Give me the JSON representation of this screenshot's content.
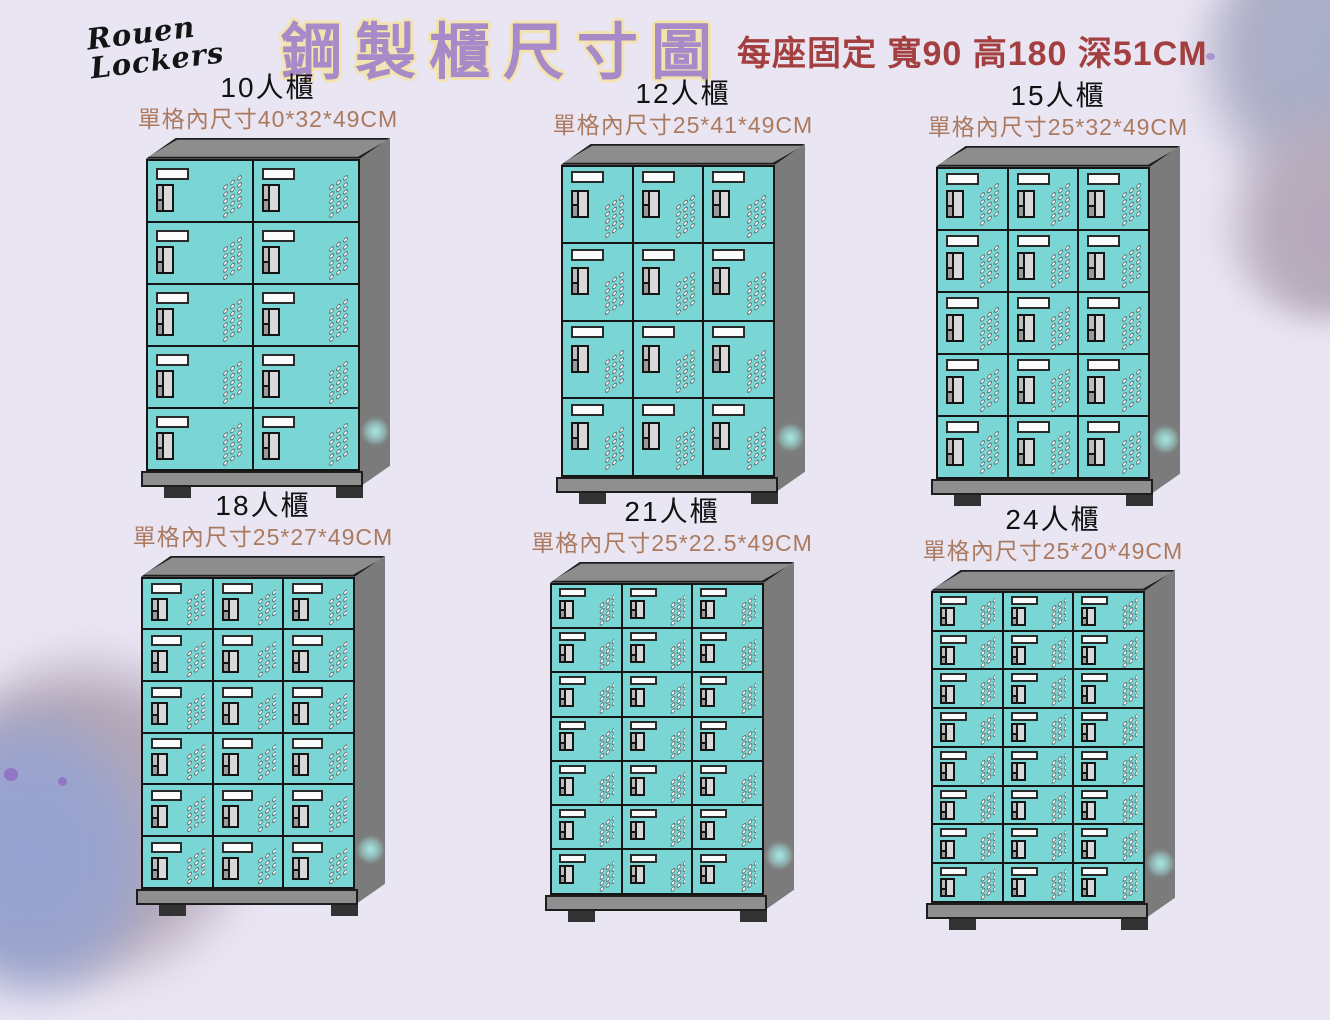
{
  "header": {
    "brand": "Rouen Lockers",
    "title": "鋼製櫃尺寸圖",
    "subtitle": "每座固定 寬90 高180 深51CM"
  },
  "colors": {
    "background": "#eae5f3",
    "title_purple": "#a78bc9",
    "title_outline_cream": "#f3e3ae",
    "subtitle_red": "#a33f3f",
    "dims_brown": "#ab7a5e",
    "door_teal": "#79d6d4",
    "cabinet_gray": "#8d8d8d",
    "side_gray": "#7b7b7b",
    "foot_dark": "#333333"
  },
  "lockers": [
    {
      "label": "10人櫃",
      "inner_dims": "單格內尺寸40*32*49CM",
      "columns": 2,
      "rows": 5,
      "capacity": 10
    },
    {
      "label": "12人櫃",
      "inner_dims": "單格內尺寸25*41*49CM",
      "columns": 3,
      "rows": 4,
      "capacity": 12
    },
    {
      "label": "15人櫃",
      "inner_dims": "單格內尺寸25*32*49CM",
      "columns": 3,
      "rows": 5,
      "capacity": 15
    },
    {
      "label": "18人櫃",
      "inner_dims": "單格內尺寸25*27*49CM",
      "columns": 3,
      "rows": 6,
      "capacity": 18
    },
    {
      "label": "21人櫃",
      "inner_dims": "單格內尺寸25*22.5*49CM",
      "columns": 3,
      "rows": 7,
      "capacity": 21
    },
    {
      "label": "24人櫃",
      "inner_dims": "單格內尺寸25*20*49CM",
      "columns": 3,
      "rows": 8,
      "capacity": 24
    }
  ]
}
